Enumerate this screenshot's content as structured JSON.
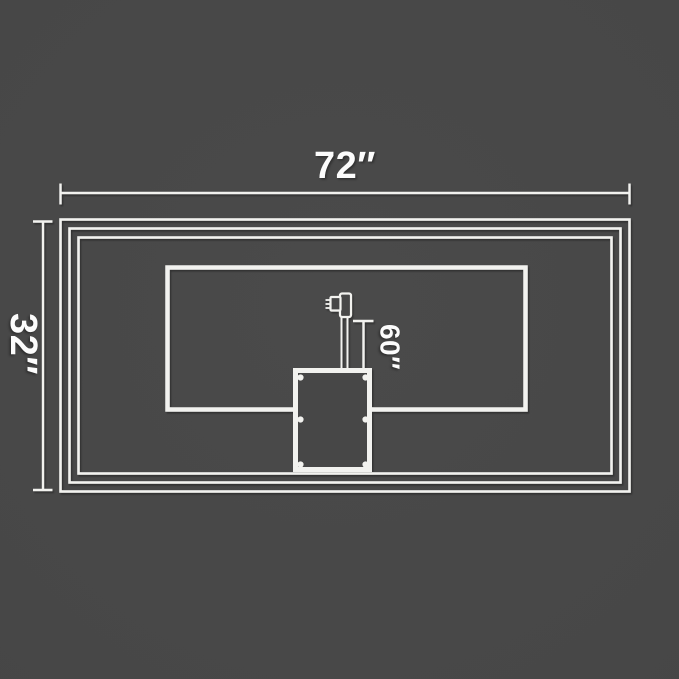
{
  "diagram": {
    "description": "Rectangular panel back-view dimension diagram with nested frame outlines, inner panel, junction box with six screws, and power plug with cord",
    "dimensions": {
      "width": {
        "label": "72″"
      },
      "height": {
        "label": "32″"
      },
      "cord": {
        "label": "60″"
      }
    },
    "colors": {
      "background": "#474747",
      "line": "#f2f2ef",
      "text": "#fcfcfc",
      "shadow": "rgba(0,0,0,0.35)"
    },
    "icons": {
      "plug": "power-plug-icon",
      "screws": "screw-dot",
      "box": "junction-box"
    }
  }
}
